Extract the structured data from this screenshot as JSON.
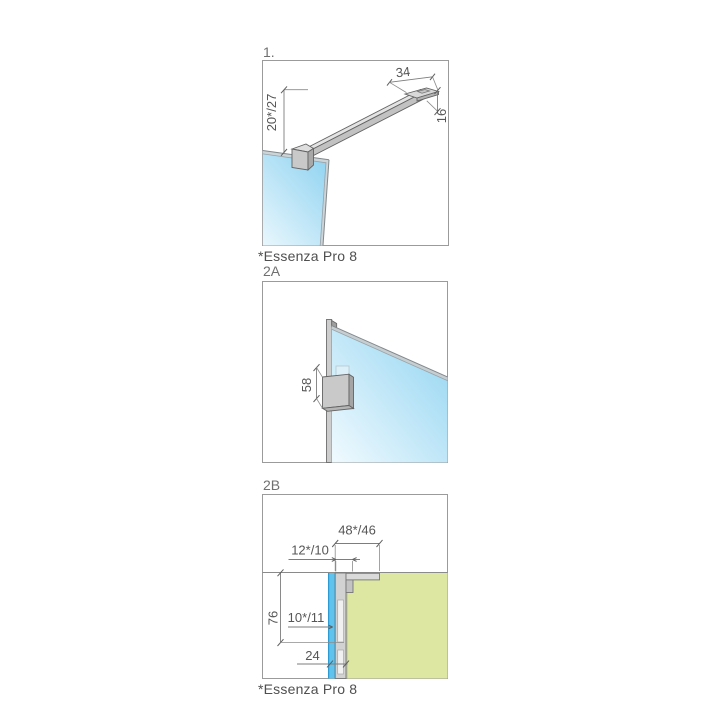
{
  "panel1": {
    "label": "1.",
    "caption": "*Essenza Pro 8",
    "dims": {
      "bracket_width": "34",
      "bar_end_height": "16",
      "glass_to_bar": "20*/27"
    }
  },
  "panel2a": {
    "label": "2A",
    "dims": {
      "bracket_height": "58"
    }
  },
  "panel2b": {
    "label": "2B",
    "caption": "*Essenza Pro 8",
    "dims": {
      "bracket_depth": "48*/46",
      "wall_offset": "12*/10",
      "profile_length": "76",
      "adjustment_range": "10*/11",
      "profile_width": "24"
    }
  },
  "colors": {
    "glass_blue": "#5fc3ee",
    "glass_gradient_dark": "#93d4f1",
    "glass_gradient_light": "#e9f7fd",
    "wall_green": "#dde7a2",
    "profile_gray": "#d2d2d2",
    "bracket_gray": "#c9c9c9",
    "outline_gray": "#767676",
    "dimension_text": "#565656",
    "panel_border": "#9b9b9b"
  }
}
